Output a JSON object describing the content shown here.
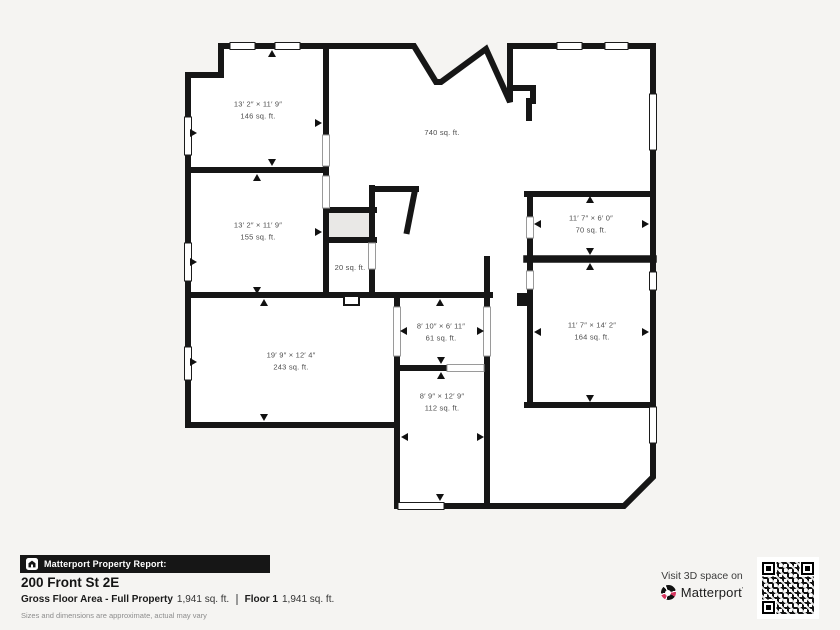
{
  "colors": {
    "background": "#f5f4f2",
    "wall": "#161616",
    "brand_pink": "#d6365f",
    "shaft_fill": "#e9e8e6"
  },
  "floor_plan": {
    "rooms": [
      {
        "name": "bedroom-top-left",
        "dims": "13′ 2″ × 11′ 9″",
        "area": "146 sq. ft."
      },
      {
        "name": "bedroom-mid-left",
        "dims": "13′ 2″ × 11′ 9″",
        "area": "155 sq. ft."
      },
      {
        "name": "room-bottom-left",
        "dims": "19′ 9″ × 12′ 4″",
        "area": "243 sq. ft."
      },
      {
        "name": "closet",
        "area": "20 sq. ft."
      },
      {
        "name": "room-center",
        "dims": "8′ 10″ × 6′ 11″",
        "area": "61 sq. ft."
      },
      {
        "name": "room-center-bottom",
        "dims": "8′ 9″ × 12′ 9″",
        "area": "112 sq. ft."
      },
      {
        "name": "room-right-top",
        "dims": "11′ 7″ × 6′ 0″",
        "area": "70 sq. ft."
      },
      {
        "name": "room-right-bottom",
        "dims": "11′ 7″ × 14′ 2″",
        "area": "164 sq. ft."
      },
      {
        "name": "open-living-area",
        "area": "740 sq. ft."
      }
    ]
  },
  "footer": {
    "report_label": "Matterport Property Report:",
    "address": "200 Front St 2E",
    "gross_area_label": "Gross Floor Area - Full Property",
    "gross_area_value": "1,941 sq. ft.",
    "floor_label": "Floor 1",
    "floor_value": "1,941 sq. ft.",
    "disclaimer": "Sizes and dimensions are approximate, actual may vary",
    "visit_text": "Visit 3D space on",
    "brand": "Matterport"
  }
}
